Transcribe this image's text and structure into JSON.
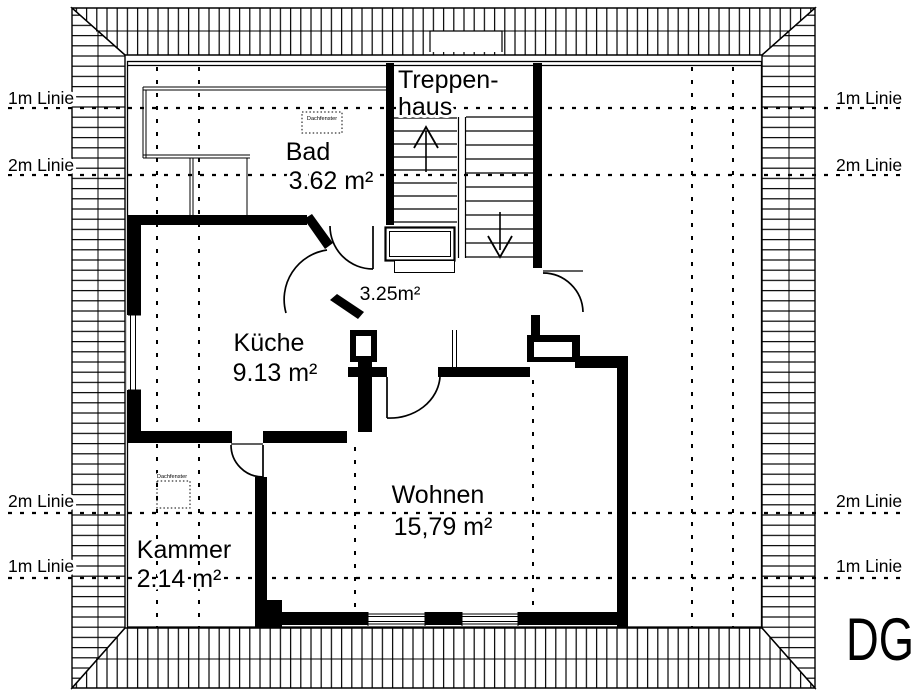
{
  "plan": {
    "floor_tag": "DG",
    "stairwell_label": {
      "line1": "Treppen-",
      "line2": "haus"
    },
    "rooms": {
      "bad": {
        "name": "Bad",
        "area": "3.62 m²"
      },
      "kueche": {
        "name": "Küche",
        "area": "9.13 m²"
      },
      "wohnen": {
        "name": "Wohnen",
        "area": "15,79 m²"
      },
      "kammer": {
        "name": "Kammer",
        "area": "2.14 m²"
      },
      "flur": {
        "area": "3.25m²"
      }
    },
    "reference_lines": {
      "one_m": "1m Linie",
      "two_m": "2m Linie"
    },
    "markers": {
      "roof_window": "Dachfenster"
    }
  },
  "colors": {
    "ink": "#000000",
    "paper": "#ffffff"
  }
}
